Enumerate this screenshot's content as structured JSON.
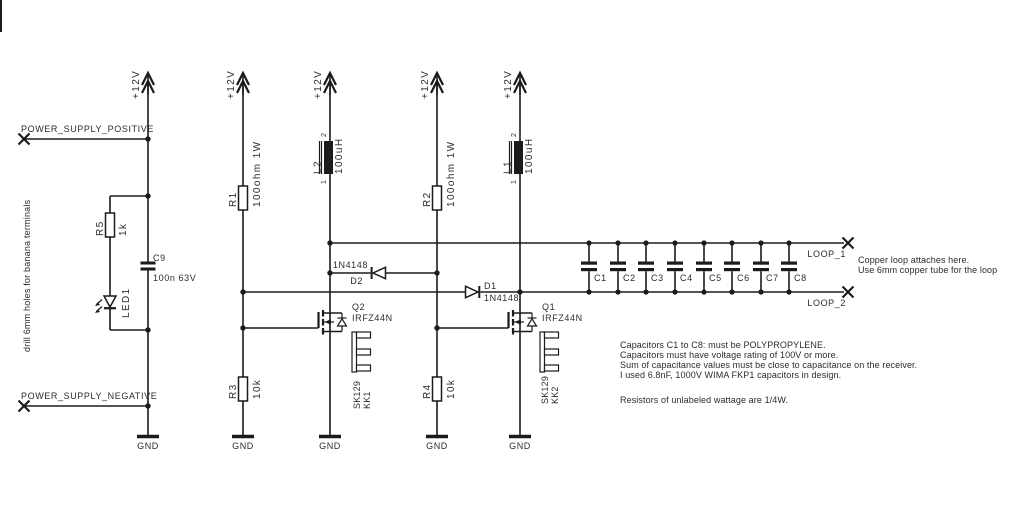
{
  "schematic": {
    "rail_label": "+12V",
    "gnd_label": "GND",
    "terminals": {
      "positive": "POWER_SUPPLY_POSITIVE",
      "negative": "POWER_SUPPLY_NEGATIVE",
      "loop1": "LOOP_1",
      "loop2": "LOOP_2"
    },
    "components": {
      "r1": {
        "ref": "R1",
        "value": "100ohm 1W"
      },
      "r2": {
        "ref": "R2",
        "value": "100ohm 1W"
      },
      "r3": {
        "ref": "R3",
        "value": "10k"
      },
      "r4": {
        "ref": "R4",
        "value": "10k"
      },
      "r5": {
        "ref": "R5",
        "value": "1k"
      },
      "c9": {
        "ref": "C9",
        "value": "100n 63V"
      },
      "led1": {
        "ref": "LED1"
      },
      "l1": {
        "ref": "L1",
        "value": "100uH",
        "pin_top": "2",
        "pin_bottom": "1"
      },
      "l2": {
        "ref": "L2",
        "value": "100uH",
        "pin_top": "2",
        "pin_bottom": "1"
      },
      "d1": {
        "ref": "D1",
        "value": "1N4148"
      },
      "d2": {
        "ref": "D2",
        "value": "1N4148"
      },
      "q1": {
        "ref": "Q1",
        "value": "IRFZ44N"
      },
      "q2": {
        "ref": "Q2",
        "value": "IRFZ44N"
      },
      "heatsink1": {
        "ref": "SK129",
        "value": "KK1"
      },
      "heatsink2": {
        "ref": "SK129",
        "value": "KK2"
      },
      "loop_caps": [
        "C1",
        "C2",
        "C3",
        "C4",
        "C5",
        "C6",
        "C7",
        "C8"
      ]
    },
    "annotations": {
      "drill_note": "drill 6mm holes for banana terminals",
      "loop_note_line1": "Copper loop attaches here.",
      "loop_note_line2": "Use 6mm copper tube for the loop",
      "cap_notes": [
        "Capacitors C1 to C8: must be POLYPROPYLENE.",
        "Capacitors must have voltage rating of 100V or more.",
        "Sum of capacitance values must be close to capacitance on the receiver.",
        "I used 6.8nF, 1000V WIMA FKP1 capacitors in design."
      ],
      "resistor_note": "Resistors of unlabeled wattage are 1/4W."
    },
    "colors": {
      "ink": "#1b1b1b",
      "background": "#ffffff"
    }
  }
}
